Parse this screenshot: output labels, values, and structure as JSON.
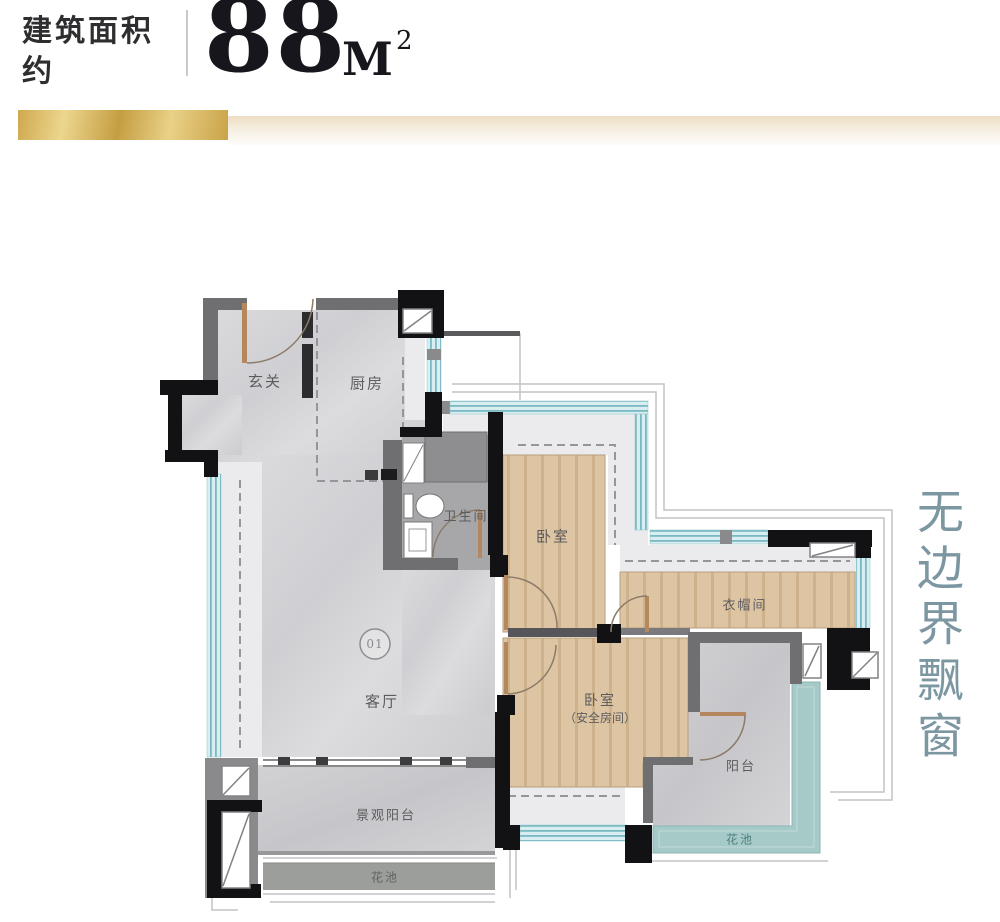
{
  "header": {
    "area_label_line1": "建筑面积",
    "area_label_line2": "约",
    "area_value": "88",
    "area_unit": "M",
    "area_exponent": "2"
  },
  "plan": {
    "unit_badge": "01",
    "rooms": {
      "entry": "玄关",
      "kitchen": "厨房",
      "bathroom": "卫生间",
      "bedroom1": "卧室",
      "closet": "衣帽间",
      "living": "客厅",
      "bedroom2_line1": "卧室",
      "bedroom2_line2": "（安全房间）",
      "balcony": "阳台",
      "view_balcony": "景观阳台",
      "flower_bed_left": "花池",
      "flower_bed_right": "花池"
    }
  },
  "side_note": {
    "text": "无边界飘窗"
  },
  "colors": {
    "gold": "#d2a94f",
    "window_teal": "#7ab9c3",
    "side_note_teal": "#7d97a2",
    "wall_black": "#121214"
  }
}
